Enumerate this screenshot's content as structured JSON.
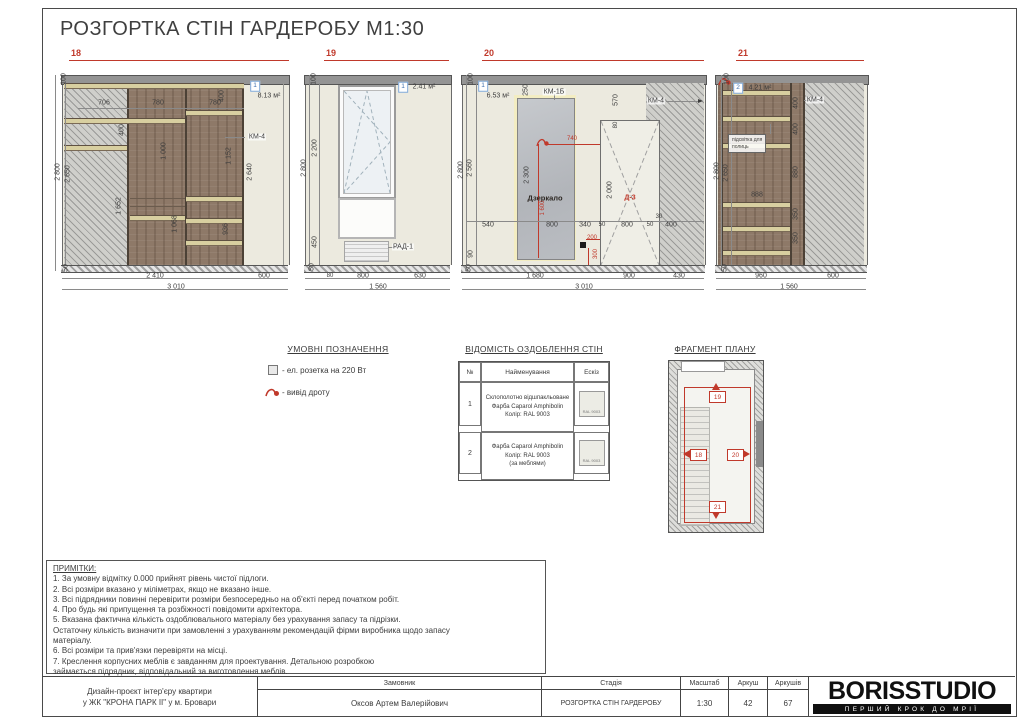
{
  "title": "РОЗГОРТКА СТІН ГАРДЕРОБУ М1:30",
  "colors": {
    "accent_red": "#c0392b",
    "wood": "#8e7968",
    "wall": "#eceadf",
    "marker_blue": "#3e6fae"
  },
  "elevations": [
    {
      "num": "18",
      "labels": [
        {
          "t": "100",
          "x": 19,
          "y": 31,
          "cls": "r"
        },
        {
          "t": "2 800",
          "x": 13,
          "y": 124,
          "cls": "r"
        },
        {
          "t": "2 650",
          "x": 23,
          "y": 126,
          "cls": "r"
        },
        {
          "t": "50",
          "x": 21,
          "y": 220,
          "cls": "r"
        },
        {
          "t": "706",
          "x": 59,
          "y": 55
        },
        {
          "t": "780",
          "x": 113,
          "y": 55
        },
        {
          "t": "780",
          "x": 170,
          "y": 55
        },
        {
          "t": "400",
          "x": 77,
          "y": 82,
          "cls": "r"
        },
        {
          "t": "1 652",
          "x": 74,
          "y": 158,
          "cls": "r"
        },
        {
          "t": "1 000",
          "x": 119,
          "y": 103,
          "cls": "r"
        },
        {
          "t": "1 068",
          "x": 130,
          "y": 176,
          "cls": "r"
        },
        {
          "t": "1 152",
          "x": 184,
          "y": 108,
          "cls": "r"
        },
        {
          "t": "936",
          "x": 181,
          "y": 181,
          "cls": "r"
        },
        {
          "t": "400",
          "x": 177,
          "y": 48,
          "cls": "r"
        },
        {
          "t": "2 640",
          "x": 205,
          "y": 124,
          "cls": "r"
        },
        {
          "t": "1",
          "x": 210,
          "y": 38,
          "cls": "box"
        },
        {
          "t": "8.13 м²",
          "x": 224,
          "y": 48
        },
        {
          "t": "КМ-4",
          "x": 212,
          "y": 89,
          "cls": "tag"
        },
        {
          "t": "2 410",
          "x": 110,
          "y": 228
        },
        {
          "t": "600",
          "x": 219,
          "y": 228
        },
        {
          "t": "3 010",
          "x": 131,
          "y": 239
        }
      ]
    },
    {
      "num": "19",
      "labels": [
        {
          "t": "100",
          "x": 14,
          "y": 31,
          "cls": "r"
        },
        {
          "t": "2 800",
          "x": 4,
          "y": 120,
          "cls": "r"
        },
        {
          "t": "2 200",
          "x": 15,
          "y": 100,
          "cls": "r"
        },
        {
          "t": "450",
          "x": 15,
          "y": 194,
          "cls": "r"
        },
        {
          "t": "50",
          "x": 12,
          "y": 219,
          "cls": "r"
        },
        {
          "t": "1",
          "x": 103,
          "y": 39,
          "cls": "box"
        },
        {
          "t": "2.41 м²",
          "x": 124,
          "y": 39
        },
        {
          "t": "РАД-1",
          "x": 103,
          "y": 199,
          "cls": "tag"
        },
        {
          "t": "80",
          "x": 30,
          "y": 228,
          "cls": "sm"
        },
        {
          "t": "800",
          "x": 63,
          "y": 228
        },
        {
          "t": "630",
          "x": 120,
          "y": 228
        },
        {
          "t": "1 560",
          "x": 78,
          "y": 239
        }
      ]
    },
    {
      "num": "20",
      "labels": [
        {
          "t": "100",
          "x": 13,
          "y": 31,
          "cls": "r"
        },
        {
          "t": "2 800",
          "x": 3,
          "y": 122,
          "cls": "r"
        },
        {
          "t": "2 560",
          "x": 12,
          "y": 120,
          "cls": "r"
        },
        {
          "t": "90",
          "x": 13,
          "y": 206,
          "cls": "r"
        },
        {
          "t": "50",
          "x": 11,
          "y": 220,
          "cls": "r"
        },
        {
          "t": "1",
          "x": 25,
          "y": 38,
          "cls": "box"
        },
        {
          "t": "6.53 м²",
          "x": 40,
          "y": 48
        },
        {
          "t": "250",
          "x": 68,
          "y": 42,
          "cls": "r"
        },
        {
          "t": "КМ-1Б",
          "x": 96,
          "y": 44,
          "cls": "tag"
        },
        {
          "t": "570",
          "x": 158,
          "y": 52,
          "cls": "r"
        },
        {
          "t": "КМ-4",
          "x": 198,
          "y": 53,
          "cls": "tag"
        },
        {
          "t": "80",
          "x": 158,
          "y": 77,
          "cls": "r sm"
        },
        {
          "t": "Дзеркало",
          "x": 87,
          "y": 150,
          "cls": "dark"
        },
        {
          "t": "2 300",
          "x": 69,
          "y": 127,
          "cls": "r"
        },
        {
          "t": "1 600",
          "x": 85,
          "y": 160,
          "cls": "r red sm"
        },
        {
          "t": "740",
          "x": 114,
          "y": 91,
          "cls": "red sm"
        },
        {
          "t": "Д-3",
          "x": 172,
          "y": 150,
          "cls": "red bold"
        },
        {
          "t": "2 000",
          "x": 152,
          "y": 142,
          "cls": "r"
        },
        {
          "t": "540",
          "x": 30,
          "y": 177
        },
        {
          "t": "800",
          "x": 94,
          "y": 177
        },
        {
          "t": "340",
          "x": 127,
          "y": 177
        },
        {
          "t": "50",
          "x": 144,
          "y": 177,
          "cls": "sm"
        },
        {
          "t": "800",
          "x": 169,
          "y": 177
        },
        {
          "t": "50",
          "x": 192,
          "y": 177,
          "cls": "sm"
        },
        {
          "t": "30",
          "x": 201,
          "y": 169,
          "cls": "sm"
        },
        {
          "t": "400",
          "x": 213,
          "y": 177
        },
        {
          "t": "200",
          "x": 134,
          "y": 190,
          "cls": "red sm"
        },
        {
          "t": "300",
          "x": 138,
          "y": 206,
          "cls": "r red sm"
        },
        {
          "t": "1 680",
          "x": 77,
          "y": 228
        },
        {
          "t": "900",
          "x": 171,
          "y": 228
        },
        {
          "t": "430",
          "x": 221,
          "y": 228
        },
        {
          "t": "3 010",
          "x": 126,
          "y": 239
        }
      ]
    },
    {
      "num": "21",
      "labels": [
        {
          "t": "100",
          "x": 15,
          "y": 31,
          "cls": "r"
        },
        {
          "t": "2 800",
          "x": 5,
          "y": 123,
          "cls": "r"
        },
        {
          "t": "2 650",
          "x": 14,
          "y": 125,
          "cls": "r"
        },
        {
          "t": "50",
          "x": 13,
          "y": 220,
          "cls": "r"
        },
        {
          "t": "2",
          "x": 26,
          "y": 40,
          "cls": "box"
        },
        {
          "t": "4.21 м²",
          "x": 48,
          "y": 40
        },
        {
          "t": "КМ-4",
          "x": 103,
          "y": 52,
          "cls": "tag"
        },
        {
          "t": "400",
          "x": 84,
          "y": 55,
          "cls": "r"
        },
        {
          "t": "400",
          "x": 84,
          "y": 81,
          "cls": "r"
        },
        {
          "t": "880",
          "x": 84,
          "y": 124,
          "cls": "r"
        },
        {
          "t": "350",
          "x": 84,
          "y": 166,
          "cls": "r"
        },
        {
          "t": "350",
          "x": 84,
          "y": 190,
          "cls": "r"
        },
        {
          "t": "888",
          "x": 45,
          "y": 147
        },
        {
          "t": "підсвітка для\nполиць",
          "x": 16,
          "y": 86,
          "cls": "note"
        },
        {
          "t": "960",
          "x": 49,
          "y": 228
        },
        {
          "t": "600",
          "x": 121,
          "y": 228
        },
        {
          "t": "1 560",
          "x": 77,
          "y": 239
        }
      ]
    }
  ],
  "legend": {
    "title": "УМОВНІ ПОЗНАЧЕННЯ",
    "items": [
      {
        "icon": "socket-icon",
        "text": "- ел. розетка на 220 Вт"
      },
      {
        "icon": "wire-outlet-icon",
        "text": "- вивід дроту"
      }
    ]
  },
  "finish_table": {
    "title": "ВІДОМІСТЬ ОЗДОБЛЕННЯ СТІН",
    "columns": [
      "№",
      "Найменування",
      "Ескіз"
    ],
    "rows": [
      {
        "no": "1",
        "name_lines": [
          "Склополотно відшпакльоване",
          "Фарба Caparol Amphibolin",
          "Колір: RAL 9003"
        ],
        "swatch_caption": "RAL 9003"
      },
      {
        "no": "2",
        "name_lines": [
          "Фарба Caparol Amphibolin",
          "Колір: RAL 9003",
          "(за меблями)"
        ],
        "swatch_caption": "RAL 9003"
      }
    ]
  },
  "plan": {
    "title": "ФРАГМЕНТ ПЛАНУ",
    "markers": {
      "top": "19",
      "left": "18",
      "right": "20",
      "bottom": "21"
    }
  },
  "notes": {
    "title": "ПРИМІТКИ:",
    "lines": [
      "1. За умовну відмітку 0.000 прийнят рівень чистої підлоги.",
      "2. Всі розміри вказано у міліметрах, якщо не вказано інше.",
      "3. Всі підрядники повинні перевірити розміри безпосередньо на об'єкті перед початком робіт.",
      "4. Про будь які припущення та розбіжності повідомити архітектора.",
      "5. Вказана фактична кількість оздоблювального матеріалу без урахування запасу та підрізки.",
      "Остаточну кількість визначити при замовленні з урахуванням рекомендацій фірми виробника щодо запасу",
      "матеріалу.",
      "6. Всі розміри та прив'язки перевіряти на місці.",
      "7. Креслення корпусних меблів є завданням для проектування. Детальною розробкою",
      "займається підрядник, відповідальний за виготовлення меблів."
    ]
  },
  "titleblock": {
    "project_line1": "Дизайн-проєкт інтер'єру квартири",
    "project_line2": "у ЖК \"КРОНА ПАРК ІІ\" у м. Бровари",
    "customer_label": "Замовник",
    "customer": "Оксов Артем Валерійович",
    "stage_label": "Стадія",
    "stage": "РОЗГОРТКА СТІН ГАРДЕРОБУ",
    "scale_label": "Масштаб",
    "scale": "1:30",
    "sheet_label": "Аркуш",
    "sheet": "42",
    "sheets_label": "Аркушів",
    "sheets": "67"
  },
  "logo": {
    "name": "BORISSTUDIO",
    "tagline": "ПЕРШИЙ КРОК ДО МРІЇ"
  }
}
